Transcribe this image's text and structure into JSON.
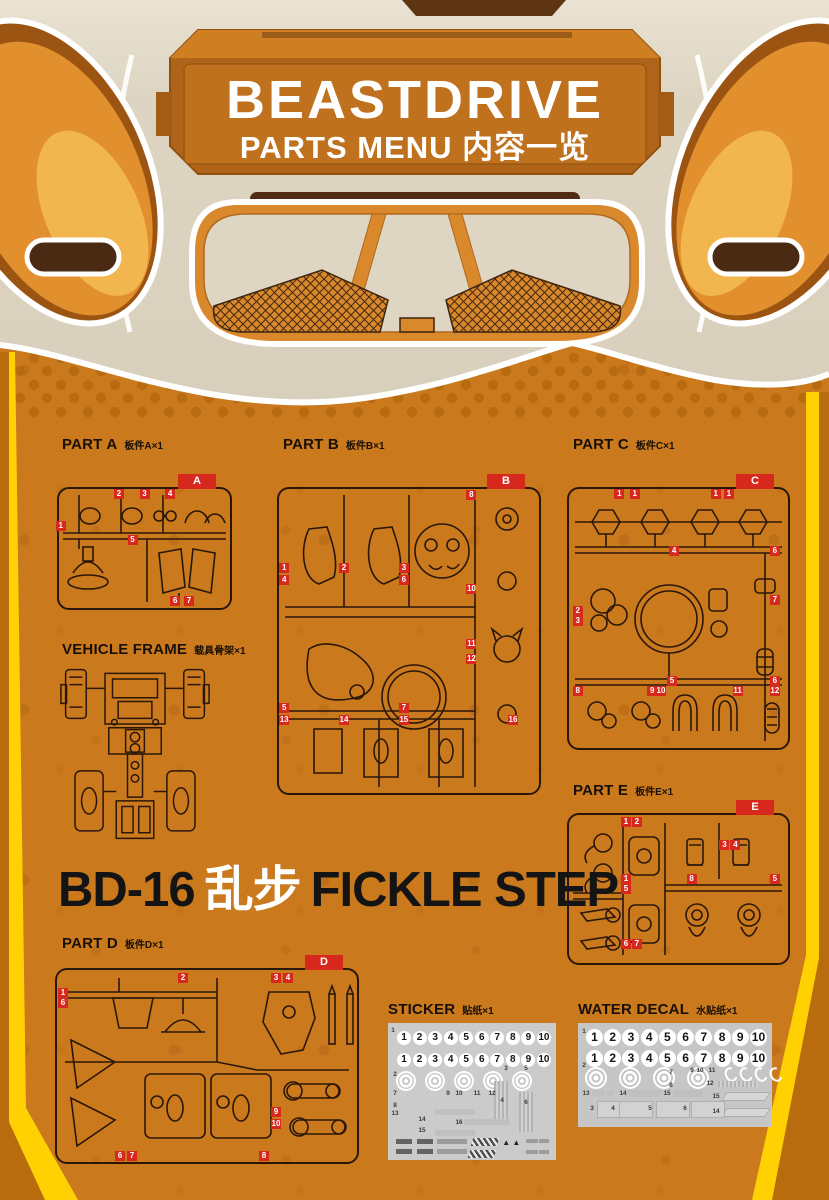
{
  "header": {
    "title": "BEASTDRIVE",
    "subtitle": "PARTS MENU 内容一览"
  },
  "product": {
    "model": "BD-16",
    "cn_name": "乱步",
    "en_name": "FICKLE STEP"
  },
  "colors": {
    "background_orange": "#cb791d",
    "frame_yellow": "#ffd103",
    "frame_outer_orange": "#b96c0e",
    "tag_red": "#d7281d",
    "face_cream": "#dcd4c1",
    "line_dark": "#2a1708",
    "sheet_gray": "#cbcbcb",
    "banner_orange": "#b0641a"
  },
  "sections": {
    "part_a": {
      "en": "PART A",
      "cn": "板件A×1"
    },
    "part_b": {
      "en": "PART B",
      "cn": "板件B×1"
    },
    "part_c": {
      "en": "PART C",
      "cn": "板件C×1"
    },
    "part_d": {
      "en": "PART D",
      "cn": "板件D×1"
    },
    "part_e": {
      "en": "PART E",
      "cn": "板件E×1"
    },
    "vehicle_frame": {
      "en": "VEHICLE FRAME",
      "cn": "载具骨架×1"
    },
    "sticker": {
      "en": "STICKER",
      "cn": "贴纸×1"
    },
    "water_decal": {
      "en": "WATER DECAL",
      "cn": "水贴纸×1"
    }
  },
  "sprues": {
    "a": {
      "letter": "A",
      "tags": [
        {
          "t": "2",
          "x": 35,
          "y": 4
        },
        {
          "t": "3",
          "x": 50,
          "y": 4
        },
        {
          "t": "4",
          "x": 65,
          "y": 4
        },
        {
          "t": "1",
          "x": 1,
          "y": 31
        },
        {
          "t": "5",
          "x": 43,
          "y": 43
        },
        {
          "t": "6",
          "x": 68,
          "y": 94
        },
        {
          "t": "7",
          "x": 76,
          "y": 94
        }
      ]
    },
    "b": {
      "letter": "B",
      "tags": [
        {
          "t": "8",
          "x": 74,
          "y": 2
        },
        {
          "t": "1",
          "x": 2,
          "y": 26
        },
        {
          "t": "2",
          "x": 25,
          "y": 26
        },
        {
          "t": "3",
          "x": 48,
          "y": 26
        },
        {
          "t": "4",
          "x": 2,
          "y": 30
        },
        {
          "t": "6",
          "x": 48,
          "y": 30
        },
        {
          "t": "10",
          "x": 74,
          "y": 33
        },
        {
          "t": "11",
          "x": 74,
          "y": 51
        },
        {
          "t": "12",
          "x": 74,
          "y": 56
        },
        {
          "t": "5",
          "x": 2,
          "y": 72
        },
        {
          "t": "7",
          "x": 48,
          "y": 72
        },
        {
          "t": "13",
          "x": 2,
          "y": 76
        },
        {
          "t": "14",
          "x": 25,
          "y": 76
        },
        {
          "t": "15",
          "x": 48,
          "y": 76
        },
        {
          "t": "16",
          "x": 90,
          "y": 76
        }
      ]
    },
    "c": {
      "letter": "C",
      "tags": [
        {
          "t": "1",
          "x": 23,
          "y": 2
        },
        {
          "t": "1",
          "x": 30,
          "y": 2
        },
        {
          "t": "1",
          "x": 67,
          "y": 2
        },
        {
          "t": "1",
          "x": 73,
          "y": 2
        },
        {
          "t": "4",
          "x": 48,
          "y": 24
        },
        {
          "t": "6",
          "x": 94,
          "y": 24
        },
        {
          "t": "7",
          "x": 94,
          "y": 43
        },
        {
          "t": "2",
          "x": 4,
          "y": 47
        },
        {
          "t": "3",
          "x": 4,
          "y": 51
        },
        {
          "t": "5",
          "x": 47,
          "y": 74
        },
        {
          "t": "6",
          "x": 94,
          "y": 74
        },
        {
          "t": "8",
          "x": 4,
          "y": 78
        },
        {
          "t": "9",
          "x": 38,
          "y": 78
        },
        {
          "t": "10",
          "x": 42,
          "y": 78
        },
        {
          "t": "11",
          "x": 77,
          "y": 78
        },
        {
          "t": "12",
          "x": 94,
          "y": 78
        }
      ]
    },
    "d": {
      "letter": "D",
      "tags": [
        {
          "t": "1",
          "x": 2,
          "y": 12
        },
        {
          "t": "6",
          "x": 2,
          "y": 17
        },
        {
          "t": "2",
          "x": 42,
          "y": 4
        },
        {
          "t": "3",
          "x": 73,
          "y": 4
        },
        {
          "t": "4",
          "x": 77,
          "y": 4
        },
        {
          "t": "9",
          "x": 73,
          "y": 74
        },
        {
          "t": "10",
          "x": 73,
          "y": 80
        },
        {
          "t": "6",
          "x": 21,
          "y": 97
        },
        {
          "t": "7",
          "x": 25,
          "y": 97
        },
        {
          "t": "8",
          "x": 69,
          "y": 97
        }
      ]
    },
    "e": {
      "letter": "E",
      "tags": [
        {
          "t": "1",
          "x": 26,
          "y": 5
        },
        {
          "t": "2",
          "x": 31,
          "y": 5
        },
        {
          "t": "3",
          "x": 71,
          "y": 20
        },
        {
          "t": "4",
          "x": 76,
          "y": 20
        },
        {
          "t": "1",
          "x": 26,
          "y": 43
        },
        {
          "t": "8",
          "x": 56,
          "y": 43
        },
        {
          "t": "5",
          "x": 94,
          "y": 43
        },
        {
          "t": "5",
          "x": 26,
          "y": 50
        },
        {
          "t": "6",
          "x": 26,
          "y": 87
        },
        {
          "t": "7",
          "x": 31,
          "y": 87
        }
      ]
    }
  },
  "sticker_sheet": {
    "numbers": [
      "1",
      "2",
      "3",
      "4",
      "5",
      "6",
      "7",
      "8",
      "9",
      "10"
    ],
    "indices": [
      {
        "t": "1",
        "x": 3,
        "y": 5
      },
      {
        "t": "2",
        "x": 4,
        "y": 37
      },
      {
        "t": "7",
        "x": 4,
        "y": 51
      },
      {
        "t": "9",
        "x": 36,
        "y": 51
      },
      {
        "t": "10",
        "x": 42,
        "y": 51
      },
      {
        "t": "11",
        "x": 53,
        "y": 51
      },
      {
        "t": "12",
        "x": 62,
        "y": 51
      },
      {
        "t": "8",
        "x": 4,
        "y": 60
      },
      {
        "t": "13",
        "x": 4,
        "y": 66
      },
      {
        "t": "14",
        "x": 20,
        "y": 70
      },
      {
        "t": "15",
        "x": 20,
        "y": 78
      },
      {
        "t": "16",
        "x": 42,
        "y": 72
      },
      {
        "t": "3",
        "x": 70,
        "y": 33
      },
      {
        "t": "5",
        "x": 82,
        "y": 33
      },
      {
        "t": "4",
        "x": 68,
        "y": 56
      },
      {
        "t": "6",
        "x": 82,
        "y": 58
      }
    ]
  },
  "decal_sheet": {
    "numbers": [
      "1",
      "2",
      "3",
      "4",
      "5",
      "6",
      "7",
      "8",
      "9",
      "10"
    ],
    "indices": [
      {
        "t": "1",
        "x": 3,
        "y": 8
      },
      {
        "t": "2",
        "x": 3,
        "y": 40
      },
      {
        "t": "7",
        "x": 48,
        "y": 47
      },
      {
        "t": "9",
        "x": 59,
        "y": 45
      },
      {
        "t": "10",
        "x": 63,
        "y": 45
      },
      {
        "t": "11",
        "x": 69,
        "y": 45
      },
      {
        "t": "8",
        "x": 48,
        "y": 60
      },
      {
        "t": "12",
        "x": 68,
        "y": 58
      },
      {
        "t": "13",
        "x": 4,
        "y": 67
      },
      {
        "t": "14",
        "x": 23,
        "y": 67
      },
      {
        "t": "15",
        "x": 46,
        "y": 67
      },
      {
        "t": "15",
        "x": 71,
        "y": 70
      },
      {
        "t": "14",
        "x": 71,
        "y": 85
      },
      {
        "t": "3",
        "x": 7,
        "y": 82
      },
      {
        "t": "4",
        "x": 18,
        "y": 82
      },
      {
        "t": "5",
        "x": 37,
        "y": 82
      },
      {
        "t": "6",
        "x": 55,
        "y": 82
      }
    ]
  }
}
